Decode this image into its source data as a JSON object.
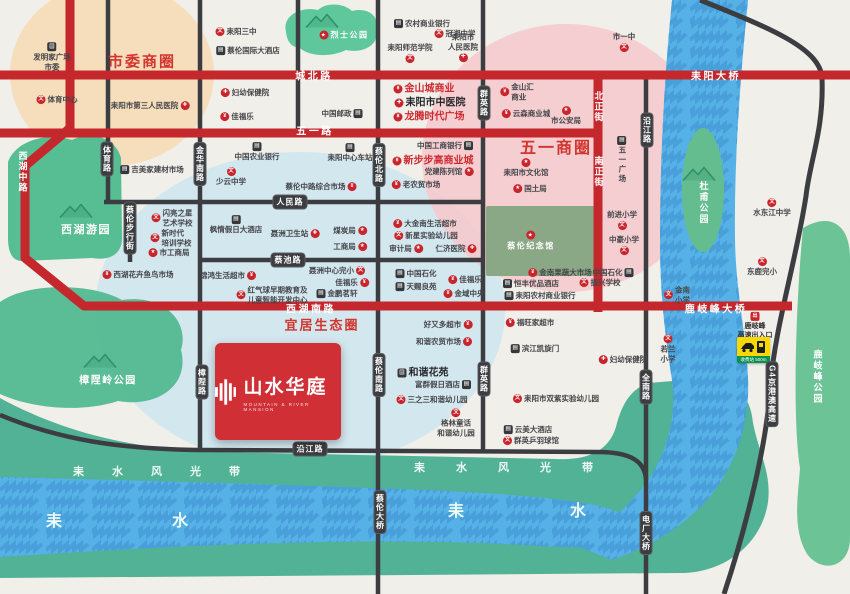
{
  "logo": {
    "name": "山水华庭",
    "subtitle": "MOUNTAIN & RIVER MANSION"
  },
  "colors": {
    "brand_red": "#d02f35",
    "road_red": "#c4272c",
    "road_dark": "#3b3d40",
    "water_blue": "#56b2e6",
    "eco_green": "#52b295",
    "circle_pink": "#f6c8cd",
    "circle_peach": "#f6dcba",
    "circle_blue": "#cfe6f0"
  },
  "icon_glyphs": {
    "school": "文",
    "hospital": "✚",
    "shop": "¥",
    "star": "★",
    "building": "▤",
    "dot": "出"
  },
  "zones": [
    {
      "label": "市委商圈",
      "x": 142,
      "y": 61,
      "size": 15
    },
    {
      "label": "五一商圈",
      "x": 556,
      "y": 146,
      "size": 16
    },
    {
      "label": "宜居生态圈",
      "x": 322,
      "y": 324,
      "size": 13
    }
  ],
  "parks": [
    {
      "label": "烈士公园",
      "x": 344,
      "y": 35,
      "star": "l",
      "size": 8,
      "mx": 322,
      "my": 21
    },
    {
      "label": "西湖游园",
      "x": 86,
      "y": 229,
      "size": 11,
      "mx": 76,
      "my": 211
    },
    {
      "label": "樟陧岭公园",
      "x": 108,
      "y": 379,
      "size": 10,
      "mx": 100,
      "my": 361
    },
    {
      "label": "杜甫公园",
      "x": 704,
      "y": 203,
      "vert": true,
      "mx": 699,
      "my": 174
    },
    {
      "label": "鹿岐峰公园",
      "x": 818,
      "y": 377,
      "vert": true
    },
    {
      "label": "蔡伦纪念馆",
      "x": 531,
      "y": 241,
      "star": "t",
      "size": 8
    }
  ],
  "river": {
    "band_label": "耒水风光带",
    "name": "耒水"
  },
  "band_texts": [
    {
      "x": 73,
      "y": 463,
      "ls": 28,
      "fs": 11
    },
    {
      "x": 414,
      "y": 459,
      "ls": 31,
      "fs": 11
    }
  ],
  "name_texts": [
    {
      "x": 46,
      "y": 507,
      "ls": 110,
      "fs": 16
    },
    {
      "x": 448,
      "y": 497,
      "ls": 106,
      "fs": 16
    }
  ],
  "toll": {
    "sign_text": "收费站 500m"
  },
  "road_labels": [
    {
      "t": "城北路",
      "x": 314,
      "y": 75,
      "type": "red-h"
    },
    {
      "t": "耒阳大桥",
      "x": 716,
      "y": 75,
      "type": "red-h"
    },
    {
      "t": "五一路",
      "x": 315,
      "y": 130,
      "type": "red-h"
    },
    {
      "t": "西湖南路",
      "x": 311,
      "y": 308,
      "type": "red-h"
    },
    {
      "t": "鹿岐峰大桥",
      "x": 716,
      "y": 308,
      "type": "red-h"
    },
    {
      "t": "西湖中路",
      "x": 23,
      "y": 172,
      "type": "red-v"
    },
    {
      "t": "北正街",
      "x": 599,
      "y": 107,
      "type": "red-v"
    },
    {
      "t": "南正街",
      "x": 599,
      "y": 172,
      "type": "red-v"
    },
    {
      "t": "体育路",
      "x": 107,
      "y": 159,
      "type": "dark-v"
    },
    {
      "t": "金华南路",
      "x": 200,
      "y": 164,
      "type": "dark-v"
    },
    {
      "t": "蔡伦步行街",
      "x": 130,
      "y": 228,
      "type": "dark-v"
    },
    {
      "t": "蔡伦北路",
      "x": 379,
      "y": 165,
      "type": "dark-v"
    },
    {
      "t": "群英路",
      "x": 484,
      "y": 103,
      "type": "dark-v"
    },
    {
      "t": "群英路",
      "x": 484,
      "y": 379,
      "type": "dark-v"
    },
    {
      "t": "沿江路",
      "x": 647,
      "y": 130,
      "type": "dark-v"
    },
    {
      "t": "樟陧路",
      "x": 202,
      "y": 382,
      "type": "dark-v"
    },
    {
      "t": "蔡伦南路",
      "x": 379,
      "y": 375,
      "type": "dark-v"
    },
    {
      "t": "全南路",
      "x": 646,
      "y": 387,
      "type": "dark-v"
    },
    {
      "t": "蔡伦大桥",
      "x": 380,
      "y": 512,
      "type": "dark-v"
    },
    {
      "t": "电厂大桥",
      "x": 646,
      "y": 533,
      "type": "dark-v"
    },
    {
      "t": "G4京港澳高速",
      "x": 772,
      "y": 394,
      "type": "dark-v"
    },
    {
      "t": "人民路",
      "x": 290,
      "y": 202,
      "type": "dark-h"
    },
    {
      "t": "蔡池路",
      "x": 288,
      "y": 260,
      "type": "dark-h"
    },
    {
      "t": "沿江路",
      "x": 310,
      "y": 449,
      "type": "dark-h"
    }
  ],
  "pois": [
    {
      "t": "发明家广场\n市委",
      "x": 52,
      "y": 57,
      "i": "building",
      "ip": "t"
    },
    {
      "t": "体育中心",
      "x": 57,
      "y": 100,
      "i": "school",
      "ip": "l"
    },
    {
      "t": "耒阳市第三人民医院",
      "x": 150,
      "y": 106,
      "i": "hospital",
      "ip": "r"
    },
    {
      "t": "耒阳三中",
      "x": 236,
      "y": 32,
      "i": "school",
      "ip": "l"
    },
    {
      "t": "蔡伦国际大酒店",
      "x": 248,
      "y": 51,
      "i": "building",
      "ip": "l"
    },
    {
      "t": "妇幼保健院",
      "x": 245,
      "y": 93,
      "i": "hospital",
      "ip": "l"
    },
    {
      "t": "佳福乐",
      "x": 237,
      "y": 117,
      "i": "shop",
      "ip": "l"
    },
    {
      "t": "农村商业银行",
      "x": 422,
      "y": 24,
      "i": "building",
      "ip": "l"
    },
    {
      "t": "冠湘中学",
      "x": 455,
      "y": 34,
      "i": "school",
      "ip": "l"
    },
    {
      "t": "耒阳市\n人民医院",
      "x": 463,
      "y": 47,
      "i": "hospital",
      "ip": "b"
    },
    {
      "t": "耒阳师范学院",
      "x": 410,
      "y": 53,
      "i": "school",
      "ip": "b"
    },
    {
      "t": "市一中",
      "x": 624,
      "y": 42,
      "i": "school",
      "ip": "b"
    },
    {
      "t": "金山城商业",
      "x": 424,
      "y": 89,
      "i": "shop",
      "ip": "l",
      "s": "red-bold"
    },
    {
      "t": "耒阳市中医院",
      "x": 430,
      "y": 103,
      "i": "hospital",
      "ip": "l",
      "s": "dark-bold"
    },
    {
      "t": "龙腾时代广场",
      "x": 429,
      "y": 117,
      "i": "shop",
      "ip": "l",
      "s": "red-bold"
    },
    {
      "t": "金山汇\n商业",
      "x": 517,
      "y": 92,
      "i": "shop",
      "ip": "l"
    },
    {
      "t": "云森商业城",
      "x": 526,
      "y": 114,
      "i": "shop",
      "ip": "l"
    },
    {
      "t": "市公安局",
      "x": 566,
      "y": 116,
      "i": "star",
      "ip": "t"
    },
    {
      "t": "中国邮政",
      "x": 342,
      "y": 114,
      "i": "building",
      "ip": "r"
    },
    {
      "t": "中国工商银行",
      "x": 445,
      "y": 146,
      "i": "building",
      "ip": "r"
    },
    {
      "t": "五一广场",
      "x": 622,
      "y": 160,
      "i": "building",
      "ip": "t",
      "v": true
    },
    {
      "t": "吉美家建材市场",
      "x": 152,
      "y": 170,
      "i": "building",
      "ip": "l"
    },
    {
      "t": "中国农业银行",
      "x": 257,
      "y": 152,
      "i": "building",
      "ip": "t"
    },
    {
      "t": "少云中学",
      "x": 231,
      "y": 177,
      "i": "school",
      "ip": "t"
    },
    {
      "t": "耒阳中心车站",
      "x": 350,
      "y": 153,
      "i": "building",
      "ip": "t"
    },
    {
      "t": "新步步高商业城",
      "x": 433,
      "y": 161,
      "i": "shop",
      "ip": "l",
      "s": "red-bold"
    },
    {
      "t": "党建陈列馆",
      "x": 449,
      "y": 172,
      "i": "star",
      "ip": "r"
    },
    {
      "t": "耒阳市文化馆",
      "x": 526,
      "y": 168,
      "i": "star",
      "ip": "t"
    },
    {
      "t": "国土局",
      "x": 530,
      "y": 189,
      "i": "star",
      "ip": "l"
    },
    {
      "t": "闪亮之星\n艺术学校",
      "x": 172,
      "y": 218,
      "i": "school",
      "ip": "l"
    },
    {
      "t": "新时代\n培训学校",
      "x": 171,
      "y": 238,
      "i": "school",
      "ip": "l"
    },
    {
      "t": "市工商局",
      "x": 169,
      "y": 253,
      "i": "star",
      "ip": "l"
    },
    {
      "t": "枫情假日大酒店",
      "x": 236,
      "y": 225,
      "i": "building",
      "ip": "t"
    },
    {
      "t": "聂洲卫生站",
      "x": 295,
      "y": 234,
      "i": "hospital",
      "ip": "r"
    },
    {
      "t": "蔡伦中路综合市场",
      "x": 321,
      "y": 187,
      "i": "shop",
      "ip": "r"
    },
    {
      "t": "老农贸市场",
      "x": 416,
      "y": 185,
      "i": "shop",
      "ip": "l"
    },
    {
      "t": "煤炭局",
      "x": 350,
      "y": 231,
      "i": "star",
      "ip": "r"
    },
    {
      "t": "工商局",
      "x": 350,
      "y": 247,
      "i": "star",
      "ip": "r"
    },
    {
      "t": "大金南生活超市",
      "x": 425,
      "y": 224,
      "i": "shop",
      "ip": "l"
    },
    {
      "t": "新星实验幼儿园",
      "x": 426,
      "y": 236,
      "i": "school",
      "ip": "l"
    },
    {
      "t": "审计局",
      "x": 406,
      "y": 249,
      "i": "star",
      "ip": "r"
    },
    {
      "t": "仁济医院",
      "x": 456,
      "y": 249,
      "i": "hospital",
      "ip": "r"
    },
    {
      "t": "前进小学",
      "x": 622,
      "y": 220,
      "i": "school",
      "ip": "b"
    },
    {
      "t": "中豪小学",
      "x": 624,
      "y": 245,
      "i": "school",
      "ip": "b"
    },
    {
      "t": "水东江中学",
      "x": 772,
      "y": 208,
      "i": "school",
      "ip": "t"
    },
    {
      "t": "东鹿完小",
      "x": 762,
      "y": 267,
      "i": "school",
      "ip": "t"
    },
    {
      "t": "西湖花卉鱼鸟市场",
      "x": 138,
      "y": 275,
      "i": "shop",
      "ip": "l"
    },
    {
      "t": "锦鸿生活超市",
      "x": 228,
      "y": 276,
      "i": "shop",
      "ip": "r"
    },
    {
      "t": "红气球早期教育及\n儿童智能开发中心",
      "x": 272,
      "y": 295,
      "i": "school",
      "ip": "l"
    },
    {
      "t": "聂洲中心完小",
      "x": 337,
      "y": 271,
      "i": "school",
      "ip": "r"
    },
    {
      "t": "佳福乐",
      "x": 352,
      "y": 283,
      "i": "shop",
      "ip": "r"
    },
    {
      "t": "金鹏茗轩",
      "x": 337,
      "y": 294,
      "i": "building",
      "ip": "l"
    },
    {
      "t": "中国石化",
      "x": 416,
      "y": 274,
      "i": "building",
      "ip": "l"
    },
    {
      "t": "天赐良苑",
      "x": 416,
      "y": 287,
      "i": "building",
      "ip": "l"
    },
    {
      "t": "佳福乐",
      "x": 465,
      "y": 280,
      "i": "shop",
      "ip": "l"
    },
    {
      "t": "金域中央",
      "x": 464,
      "y": 294,
      "i": "shop",
      "ip": "l"
    },
    {
      "t": "金南果蔬大市场",
      "x": 560,
      "y": 273,
      "i": "shop",
      "ip": "l"
    },
    {
      "t": "恒丰优品酒店",
      "x": 531,
      "y": 284,
      "i": "building",
      "ip": "l"
    },
    {
      "t": "耒阳农村商业银行",
      "x": 540,
      "y": 296,
      "i": "building",
      "ip": "l"
    },
    {
      "t": "振兴学校",
      "x": 600,
      "y": 283,
      "i": "school",
      "ip": "l"
    },
    {
      "t": "中国石化",
      "x": 613,
      "y": 273,
      "i": "building",
      "ip": "r"
    },
    {
      "t": "金南\n小学",
      "x": 677,
      "y": 295,
      "i": "school",
      "ip": "l"
    },
    {
      "t": "福旺家超市",
      "x": 530,
      "y": 323,
      "i": "shop",
      "ip": "l"
    },
    {
      "t": "滨江凯旋门",
      "x": 535,
      "y": 349,
      "i": "building",
      "ip": "l"
    },
    {
      "t": "好又多超市",
      "x": 448,
      "y": 325,
      "i": "shop",
      "ip": "r"
    },
    {
      "t": "和谐农贸市场",
      "x": 444,
      "y": 342,
      "i": "shop",
      "ip": "r"
    },
    {
      "t": "和谐花苑",
      "x": 423,
      "y": 373,
      "i": "building",
      "ip": "l",
      "s": "dark-bold"
    },
    {
      "t": "富群假日酒店",
      "x": 443,
      "y": 385,
      "i": "building",
      "ip": "r"
    },
    {
      "t": "三之三和谐幼儿园",
      "x": 432,
      "y": 400,
      "i": "school",
      "ip": "l"
    },
    {
      "t": "格林童话\n和谐幼儿园",
      "x": 456,
      "y": 423,
      "i": "school",
      "ip": "t"
    },
    {
      "t": "耒阳市双紫实验幼儿园",
      "x": 556,
      "y": 399,
      "i": "school",
      "ip": "l"
    },
    {
      "t": "云美大酒店",
      "x": 528,
      "y": 430,
      "i": "building",
      "ip": "l"
    },
    {
      "t": "群英乒羽球馆",
      "x": 531,
      "y": 441,
      "i": "school",
      "ip": "l"
    },
    {
      "t": "妇幼保健院",
      "x": 623,
      "y": 360,
      "i": "hospital",
      "ip": "l"
    },
    {
      "t": "若兰\n小学",
      "x": 668,
      "y": 349,
      "i": "school",
      "ip": "t"
    },
    {
      "t": "鹿岐峰\n高速出入口",
      "x": 755,
      "y": 326,
      "i": "dot",
      "ip": "t",
      "s": "bold-sm"
    }
  ]
}
